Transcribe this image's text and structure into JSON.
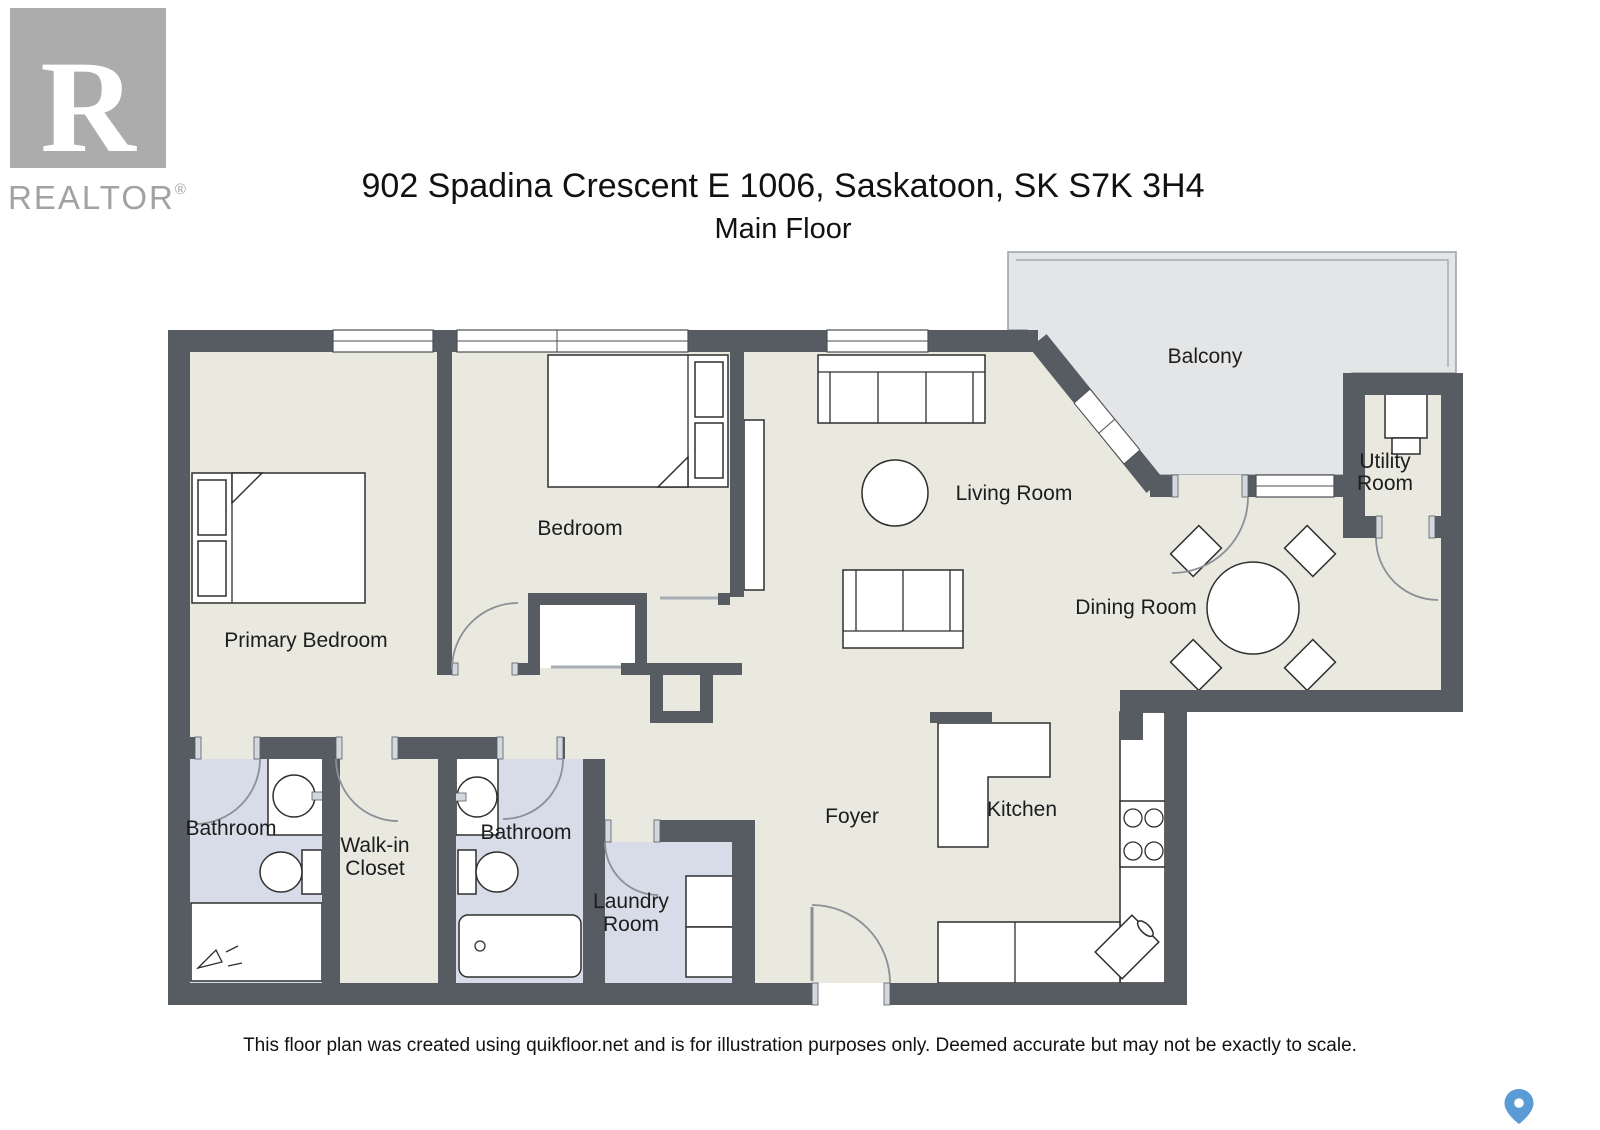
{
  "header": {
    "logo_letter": "R",
    "logo_word": "REALTOR",
    "logo_reg": "®",
    "title": "902 Spadina Crescent E 1006, Saskatoon, SK S7K 3H4",
    "subtitle": "Main Floor"
  },
  "rooms": {
    "primary_bedroom": "Primary Bedroom",
    "bedroom": "Bedroom",
    "living_room": "Living Room",
    "balcony": "Balcony",
    "utility_line1": "Utility",
    "utility_line2": "Room",
    "dining_room": "Dining Room",
    "kitchen": "Kitchen",
    "foyer": "Foyer",
    "bathroom_left": "Bathroom",
    "bathroom_right": "Bathroom",
    "walkin_line1": "Walk-in",
    "walkin_line2": "Closet",
    "laundry_line1": "Laundry",
    "laundry_line2": "Room"
  },
  "footer": {
    "disclaimer": "This floor plan was created using quikfloor.net and is for illustration purposes only. Deemed accurate but may not be exactly to scale."
  },
  "colors": {
    "wall": "#575c63",
    "floor": "#e9e9e0",
    "wet_floor": "#d7dce8",
    "balcony_floor": "#e4e5e6",
    "map_pin": "#5b9bd5"
  }
}
